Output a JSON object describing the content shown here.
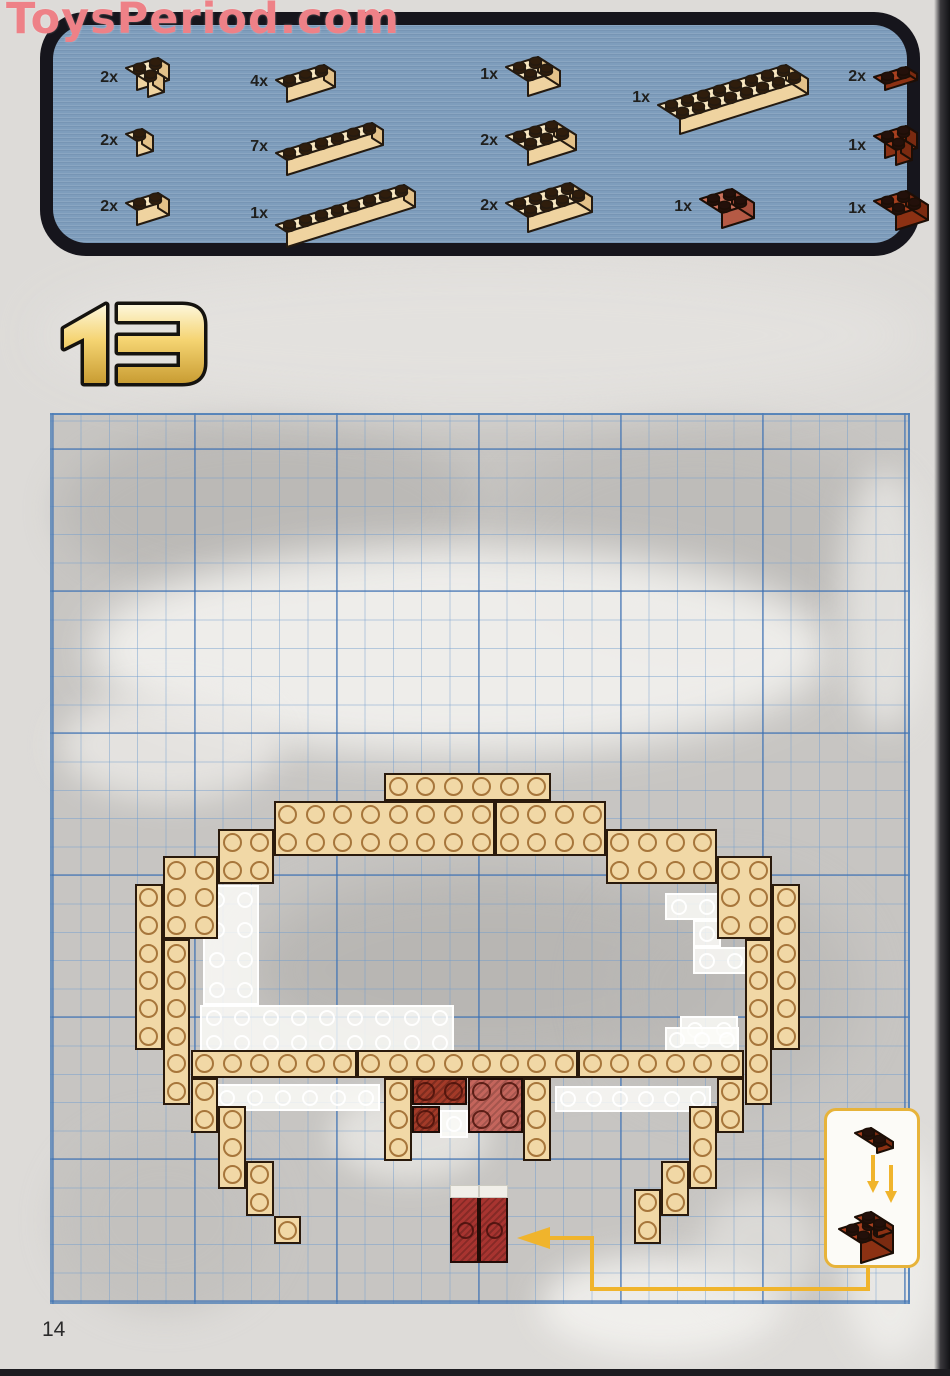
{
  "watermark": "ToysPeriod.com",
  "page_number": "14",
  "step": {
    "number": "13"
  },
  "colors": {
    "panel_blue": "#7e9dbc",
    "panel_border": "#16151c",
    "tan": "#f1d8a6",
    "tan_top": "#f7e6c0",
    "tan_front": "#efd3a0",
    "tan_side": "#e3c189",
    "red_top": "#a8401f",
    "red_front": "#8c3113",
    "red_side": "#7a2a10",
    "salmon_top": "#c9705a",
    "salmon_front": "#b55a45",
    "salmon_side": "#a64f3c",
    "stud_dark": "#2f1d0c",
    "accent_yellow": "#f0b42c",
    "watermark_pink": "#ee8187",
    "diagram_red_dark": "#a33a28",
    "diagram_red_light": "#c4655c",
    "plate_red": "#a83430"
  },
  "parts": {
    "items": [
      {
        "qty": "2x",
        "name": "brick-2x2-corner-tan",
        "x": 88,
        "y": 50,
        "c": 2,
        "d": 1,
        "kind": "corner",
        "pal": "tan"
      },
      {
        "qty": "2x",
        "name": "brick-1x1-tan",
        "x": 88,
        "y": 120,
        "c": 1,
        "d": 1,
        "kind": "brick",
        "pal": "tan"
      },
      {
        "qty": "2x",
        "name": "brick-1x2-tan",
        "x": 88,
        "y": 184,
        "c": 2,
        "d": 1,
        "kind": "brick",
        "pal": "tan"
      },
      {
        "qty": "4x",
        "name": "brick-1x3-tan",
        "x": 238,
        "y": 56,
        "c": 3,
        "d": 1,
        "kind": "brick",
        "pal": "tan"
      },
      {
        "qty": "7x",
        "name": "brick-1x6-tan",
        "x": 238,
        "y": 114,
        "c": 6,
        "d": 1,
        "kind": "brick",
        "pal": "tan"
      },
      {
        "qty": "1x",
        "name": "brick-1x8-tan",
        "x": 238,
        "y": 176,
        "c": 8,
        "d": 1,
        "kind": "brick",
        "pal": "tan"
      },
      {
        "qty": "1x",
        "name": "brick-2x2-tan",
        "x": 468,
        "y": 48,
        "c": 2,
        "d": 2,
        "kind": "brick",
        "pal": "tan"
      },
      {
        "qty": "2x",
        "name": "brick-2x3-tan",
        "x": 468,
        "y": 112,
        "c": 3,
        "d": 2,
        "kind": "brick",
        "pal": "tan"
      },
      {
        "qty": "2x",
        "name": "brick-2x4-tan",
        "x": 468,
        "y": 174,
        "c": 4,
        "d": 2,
        "kind": "brick",
        "pal": "tan"
      },
      {
        "qty": "1x",
        "name": "brick-2x8-tan",
        "x": 620,
        "y": 56,
        "c": 8,
        "d": 2,
        "kind": "brick",
        "pal": "tan"
      },
      {
        "qty": "1x",
        "name": "brick-2x2-salmon",
        "x": 662,
        "y": 180,
        "c": 2,
        "d": 2,
        "kind": "brick",
        "pal": "salmon"
      },
      {
        "qty": "2x",
        "name": "plate-1x2-redbrown",
        "x": 836,
        "y": 58,
        "c": 2,
        "d": 1,
        "kind": "plate",
        "pal": "red"
      },
      {
        "qty": "1x",
        "name": "brick-2x2-corner-redbrown",
        "x": 836,
        "y": 118,
        "c": 2,
        "d": 1,
        "kind": "corner",
        "pal": "red"
      },
      {
        "qty": "1x",
        "name": "brick-2x2-redbrown",
        "x": 836,
        "y": 182,
        "c": 2,
        "d": 2,
        "kind": "brick",
        "pal": "red"
      }
    ]
  },
  "diagram": {
    "grid": {
      "origin_x": 52,
      "origin_y": 413,
      "unit": 27.7
    },
    "tan_bricks": [
      [
        12,
        13,
        6,
        1
      ],
      [
        8,
        14,
        8,
        2
      ],
      [
        16,
        14,
        4,
        2
      ],
      [
        6,
        15,
        2,
        2
      ],
      [
        20,
        15,
        4,
        2
      ],
      [
        4,
        16,
        2,
        3
      ],
      [
        24,
        16,
        2,
        3
      ],
      [
        3,
        17,
        1,
        6
      ],
      [
        26,
        17,
        1,
        6
      ],
      [
        4,
        19,
        1,
        6
      ],
      [
        25,
        19,
        1,
        6
      ],
      [
        5,
        23,
        6,
        1
      ],
      [
        11,
        23,
        8,
        1
      ],
      [
        19,
        23,
        6,
        1
      ],
      [
        5,
        24,
        1,
        2
      ],
      [
        6,
        25,
        1,
        3
      ],
      [
        7,
        27,
        1,
        2
      ],
      [
        8,
        29,
        1,
        1
      ],
      [
        24,
        24,
        1,
        2
      ],
      [
        23,
        25,
        1,
        3
      ],
      [
        22,
        27,
        1,
        2
      ],
      [
        21,
        28,
        1,
        2
      ],
      [
        12,
        24,
        1,
        3
      ],
      [
        17,
        24,
        1,
        3
      ]
    ],
    "red_corner_cells": [
      [
        13,
        24
      ],
      [
        14,
        24
      ],
      [
        13,
        25
      ]
    ],
    "red_2x2": [
      15,
      24,
      2,
      2
    ],
    "ghost_bricks": [
      [
        203,
        885,
        56,
        120,
        2,
        4
      ],
      [
        200,
        1005,
        254,
        50,
        9,
        2
      ],
      [
        665,
        893,
        56,
        27,
        2,
        1
      ],
      [
        693,
        920,
        28,
        27,
        1,
        1
      ],
      [
        693,
        947,
        56,
        27,
        2,
        1
      ],
      [
        680,
        1016,
        58,
        28,
        2,
        1
      ],
      [
        665,
        1027,
        74,
        26,
        3,
        1
      ],
      [
        213,
        1084,
        167,
        27,
        6,
        1
      ],
      [
        555,
        1086,
        156,
        26,
        6,
        1
      ],
      [
        440,
        1110,
        28,
        28,
        1,
        1
      ]
    ],
    "standing_plates": [
      {
        "x": 450,
        "y": 1196,
        "w": 29,
        "h": 67,
        "cap": 13
      },
      {
        "x": 479,
        "y": 1196,
        "w": 29,
        "h": 67,
        "cap": 13
      }
    ],
    "connector_path": "M868 1264 L868 1289 L592 1289 L592 1238 L548 1238",
    "connector_head": "517,1238 550,1227 550,1249"
  },
  "callout": {
    "shows": "place 1x2 redbrown plate onto 2x2 redbrown brick",
    "arrow_color": "#f0b42c"
  }
}
